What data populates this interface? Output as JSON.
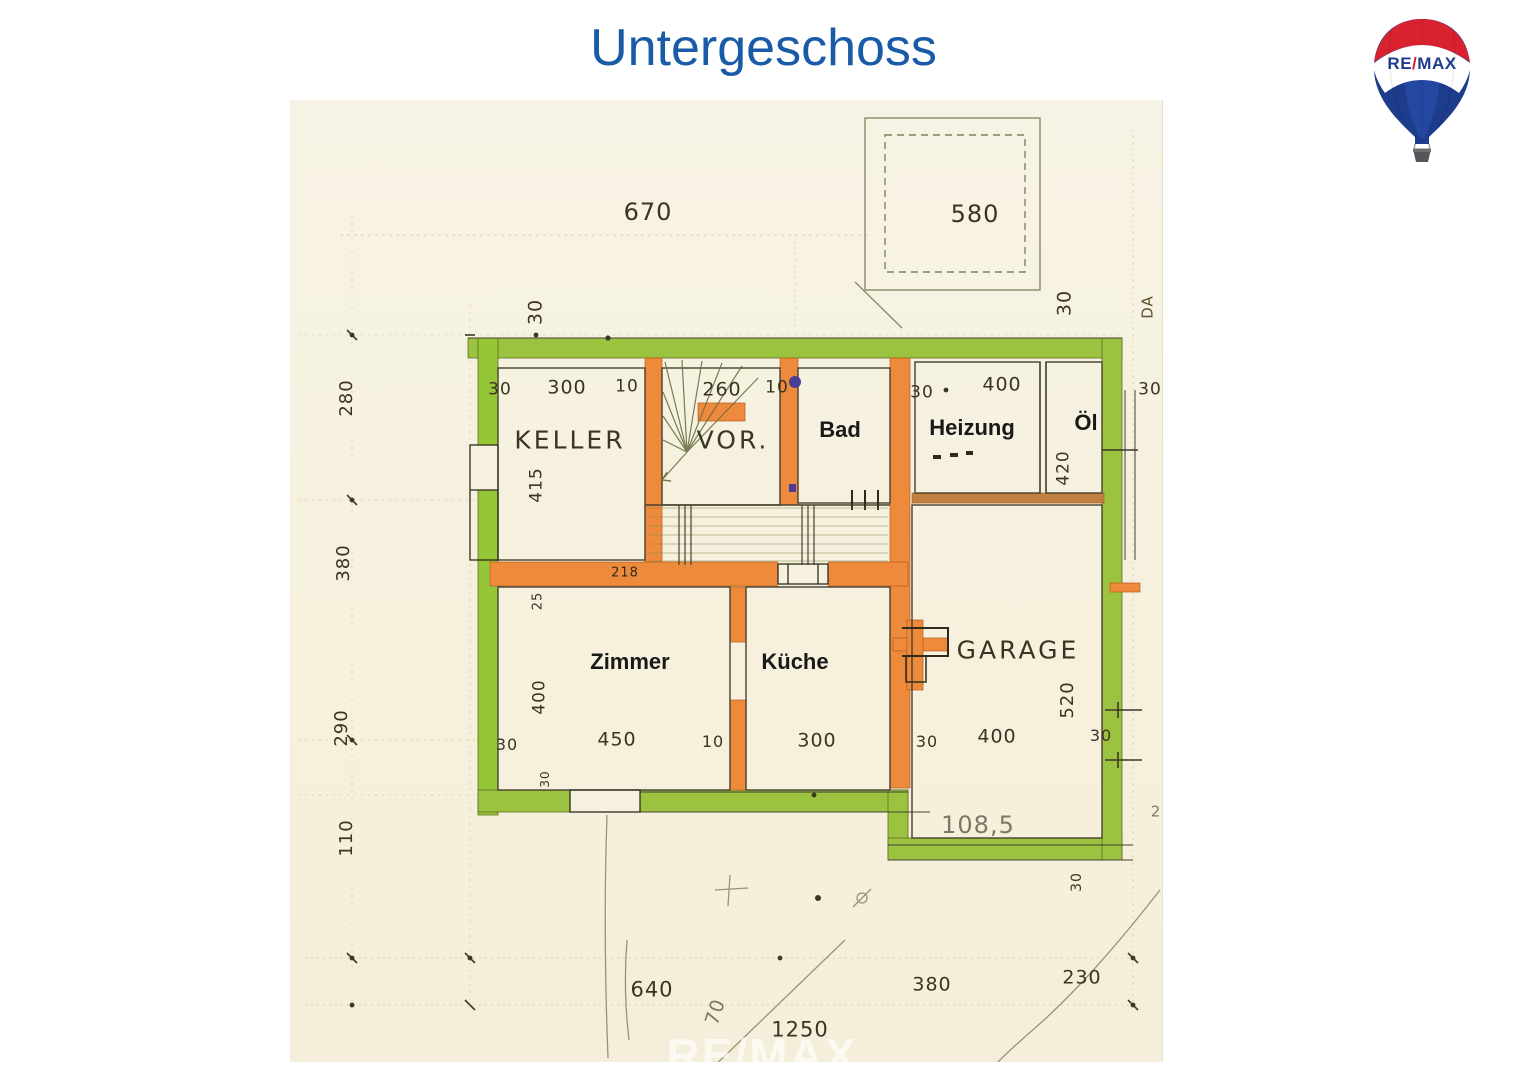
{
  "title": "Untergeschoss",
  "watermark": "RE/MAX",
  "logo": {
    "re": "RE",
    "slash": "/",
    "max": "MAX"
  },
  "colors": {
    "title_blue": "#1a5ba7",
    "wall_green": "#9cc340",
    "wall_orange": "#ee8a3b",
    "paper": "#f6f1de",
    "ink": "#45402e",
    "logo_red": "#d8222f",
    "logo_blue": "#1e3c8c"
  },
  "rooms": {
    "keller": {
      "label": "KELLER"
    },
    "vor": {
      "label": "VOR."
    },
    "bad": {
      "label": "Bad"
    },
    "heizung": {
      "label": "Heizung"
    },
    "oel": {
      "label": "Öl"
    },
    "zimmer": {
      "label": "Zimmer"
    },
    "kueche": {
      "label": "Küche"
    },
    "garage": {
      "label": "GARAGE"
    }
  },
  "dims": {
    "plot_top": "670",
    "annex_square": "580",
    "wall30": "30",
    "t10": "10",
    "keller_width": "300",
    "stair_width": "260",
    "heizung_width": "400",
    "keller_depth": "415",
    "oel_depth": "420",
    "left_280": "280",
    "left_380": "380",
    "left_290": "290",
    "left_110": "110",
    "wall_218": "218",
    "sill_25": "25",
    "zimmer_width": "450",
    "zimmer_depth": "400",
    "kueche_width": "300",
    "garage_width": "400",
    "garage_depth": "520",
    "garage_area": "108,5",
    "edge_2": "2",
    "da_note": "DA",
    "bottom_640": "640",
    "bottom_70": "70",
    "bottom_total": "1250",
    "bottom_380": "380",
    "bottom_230": "230"
  }
}
